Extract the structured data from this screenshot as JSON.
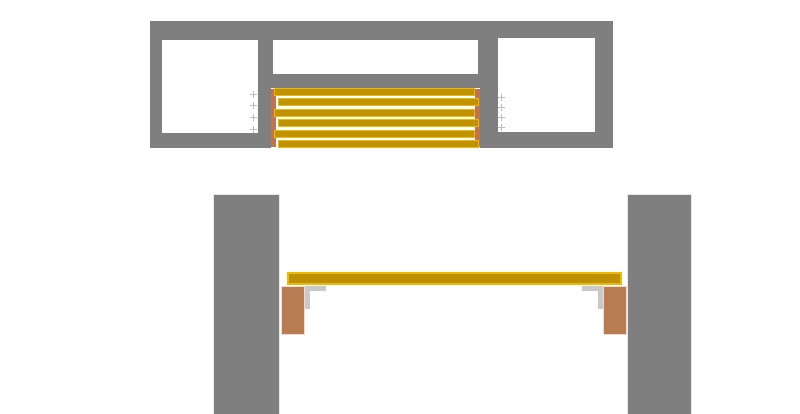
{
  "diagram": {
    "kind": "construction-drawing",
    "views": {
      "plan_view": {
        "wall_frame": {
          "openings": 3
        },
        "slats": {
          "count": 6
        },
        "end_battens": {
          "count": 2
        },
        "screw_marks": {
          "left_count": 4,
          "right_count": 4
        }
      },
      "elevation_view": {
        "pillars": {
          "count": 2
        },
        "deck_board": {
          "count": 1
        },
        "support_blocks": {
          "count": 2
        },
        "angle_brackets": {
          "count": 2
        }
      }
    }
  },
  "colors": {
    "wall_gray": "#7f7f7f",
    "slat_gold_fill": "#c09200",
    "slat_gold_border": "#eabb00",
    "deck_gold_fill": "#be9000",
    "batten_brown": "#c0734e",
    "support_block_brown": "#b87b52",
    "support_block_border": "#f2dcd2",
    "bracket_gray": "#c9c9c9",
    "screw_mark_gray": "#bdbdbd",
    "pillar_edge_light": "#e9e9e9",
    "background": "#ffffff"
  }
}
